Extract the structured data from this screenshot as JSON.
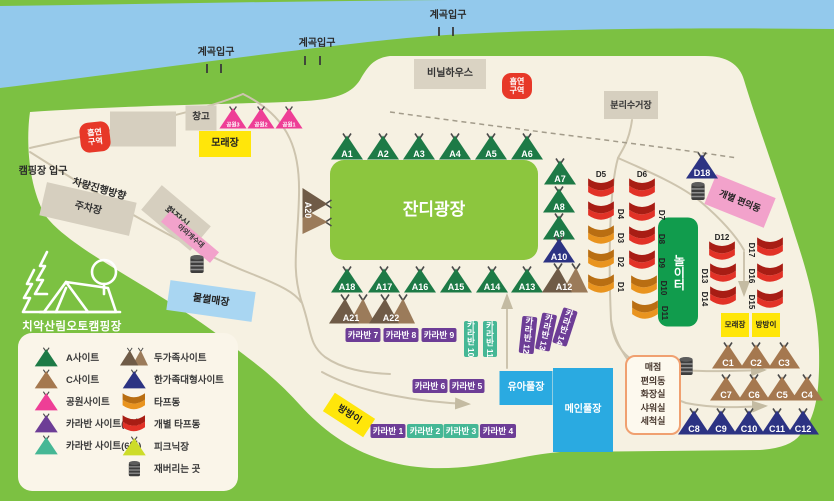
{
  "map": {
    "logo_text": "치악산림오토캠핑장",
    "colors": {
      "bg_green": "#7cc142",
      "river": "#93c9ec",
      "ground": "#f6f1e2",
      "building": "#d6cfbf",
      "yellow": "#ffe60a",
      "red_badge": "#e73828",
      "green_site": "#1d7a46",
      "navy_site": "#2c3383",
      "pink_site": "#ee3e96",
      "purple_site": "#6d3d96",
      "teal_site": "#45b795",
      "brown_site": "#a5784f",
      "brown_dark": "#6f5b47",
      "brown_light": "#9b7b5a",
      "red_tarp": "#e23227",
      "red_tarp_dark": "#a81d14",
      "orange_tarp": "#e9941f",
      "orange_tarp_dark": "#b96e12",
      "picnic": "#cddc29",
      "plaza": "#8cc63e",
      "play": "#119c4d",
      "pool": "#2aaae1",
      "sled": "#a9d6f2",
      "pink_box": "#f2a2cb"
    },
    "labels": [
      {
        "name": "valley-entrance-label-1",
        "text": "계곡입구",
        "x": 216,
        "y": 53,
        "size": 10
      },
      {
        "name": "valley-entrance-label-2",
        "text": "계곡입구",
        "x": 317,
        "y": 44,
        "size": 10
      },
      {
        "name": "valley-entrance-label-3",
        "text": "계곡입구",
        "x": 448,
        "y": 16,
        "size": 10
      },
      {
        "name": "campground-entrance-label",
        "text": "캠핑장 입구",
        "x": 43,
        "y": 172,
        "size": 10
      },
      {
        "name": "vehicle-direction-label",
        "text": "차량진행방향",
        "x": 99,
        "y": 190,
        "size": 10,
        "rotate": 16
      }
    ],
    "zones": [
      {
        "name": "zone-vinyl-house",
        "text": "비닐하우스",
        "x": 450,
        "y": 74,
        "w": 72,
        "h": 30,
        "bg": "#dad3c3",
        "fg": "#333",
        "size": 10
      },
      {
        "name": "zone-warehouse",
        "text": "창고",
        "x": 201,
        "y": 118,
        "w": 31,
        "h": 25,
        "bg": "#d6cfbf",
        "fg": "#333",
        "size": 9.5
      },
      {
        "name": "zone-building",
        "text": "",
        "x": 143,
        "y": 129,
        "w": 66,
        "h": 35,
        "bg": "#d6cfbf",
        "fg": "#333",
        "size": 9
      },
      {
        "name": "zone-recycling-station",
        "text": "분리수거장",
        "x": 631,
        "y": 105,
        "w": 54,
        "h": 28,
        "bg": "#d6cfbf",
        "fg": "#333",
        "size": 9
      },
      {
        "name": "zone-sand-area-top",
        "text": "모래장",
        "x": 225,
        "y": 144,
        "w": 52,
        "h": 26,
        "bg": "#ffe60a",
        "fg": "#222",
        "size": 10
      },
      {
        "name": "zone-parking-lot",
        "text": "주차장",
        "x": 88,
        "y": 209,
        "w": 92,
        "h": 34,
        "bg": "#d6cfbf",
        "fg": "#333",
        "size": 10,
        "rotate": 13
      },
      {
        "name": "zone-restroom",
        "text": "화장실",
        "x": 176,
        "y": 218,
        "w": 64,
        "h": 32,
        "bg": "#d6cfbf",
        "fg": "#333",
        "size": 10,
        "rotate": 40
      },
      {
        "name": "zone-outdoor-sink",
        "text": "야외개수대",
        "x": 190,
        "y": 237,
        "w": 64,
        "h": 14,
        "bg": "#f2a2cb",
        "fg": "#333",
        "size": 7,
        "rotate": 40
      },
      {
        "name": "zone-water-sled",
        "text": "물썰매장",
        "x": 211,
        "y": 301,
        "w": 86,
        "h": 30,
        "bg": "#a9d6f2",
        "fg": "#222",
        "size": 10,
        "rotate": 8
      },
      {
        "name": "zone-private-convenience",
        "text": "개별 편의동",
        "x": 740,
        "y": 201,
        "w": 64,
        "h": 32,
        "bg": "#f2a2cb",
        "fg": "#222",
        "size": 9,
        "rotate": 22
      },
      {
        "name": "zone-grass-plaza",
        "text": "잔디광장",
        "x": 434,
        "y": 210,
        "w": 208,
        "h": 100,
        "bg": "#8cc63e",
        "fg": "#fff",
        "size": 17,
        "radius": 14
      },
      {
        "name": "zone-playground",
        "text": "놀이터",
        "x": 678,
        "y": 272,
        "w": 40,
        "h": 109,
        "bg": "#119c4d",
        "fg": "#fff",
        "size": 12,
        "radius": 10,
        "vertical": true
      },
      {
        "name": "zone-kids-pool",
        "text": "유아풀장",
        "x": 526,
        "y": 388,
        "w": 53,
        "h": 34,
        "bg": "#2aaae1",
        "fg": "#fff",
        "size": 10
      },
      {
        "name": "zone-main-pool",
        "text": "메인풀장",
        "x": 583,
        "y": 410,
        "w": 60,
        "h": 84,
        "bg": "#2aaae1",
        "fg": "#fff",
        "size": 10
      },
      {
        "name": "zone-sand-area-right",
        "text": "모래장",
        "x": 735,
        "y": 325,
        "w": 28,
        "h": 24,
        "bg": "#ffe60a",
        "fg": "#222",
        "size": 7.5
      },
      {
        "name": "zone-bangbang-right",
        "text": "방방이",
        "x": 766,
        "y": 325,
        "w": 28,
        "h": 24,
        "bg": "#ffe60a",
        "fg": "#222",
        "size": 7.5
      },
      {
        "name": "zone-bangbang-bottom",
        "text": "방방이",
        "x": 349,
        "y": 415,
        "w": 48,
        "h": 22,
        "bg": "#ffe60a",
        "fg": "#222",
        "size": 9.5,
        "rotate": 33
      }
    ],
    "smoking_badges": [
      {
        "name": "smoking-area-badge-left",
        "lines": "흡연\n구역",
        "x": 95,
        "y": 137,
        "w": 30,
        "h": 30,
        "rotate": -6,
        "size": 8
      },
      {
        "name": "smoking-area-badge-right",
        "lines": "흡연\n구역",
        "x": 517,
        "y": 86,
        "w": 30,
        "h": 26,
        "rotate": 0,
        "size": 8
      }
    ],
    "caravans": [
      {
        "name": "caravan-7",
        "label": "카라반 7",
        "x": 363,
        "y": 335,
        "w": 35,
        "h": 14,
        "color": "purple"
      },
      {
        "name": "caravan-8",
        "label": "카라반 8",
        "x": 401,
        "y": 335,
        "w": 35,
        "h": 14,
        "color": "purple"
      },
      {
        "name": "caravan-9",
        "label": "카라반 9",
        "x": 439,
        "y": 335,
        "w": 35,
        "h": 14,
        "color": "purple"
      },
      {
        "name": "caravan-10",
        "label": "카라반 10",
        "x": 471,
        "y": 339,
        "w": 14,
        "h": 36,
        "color": "teal",
        "vertical": true
      },
      {
        "name": "caravan-11",
        "label": "카라반 11",
        "x": 490,
        "y": 339,
        "w": 14,
        "h": 36,
        "color": "teal",
        "vertical": true
      },
      {
        "name": "caravan-12",
        "label": "카라반 12",
        "x": 528,
        "y": 335,
        "w": 15,
        "h": 37,
        "color": "purple",
        "vertical": true,
        "rotate": 6
      },
      {
        "name": "caravan-13",
        "label": "카라반 13",
        "x": 546,
        "y": 332,
        "w": 15,
        "h": 37,
        "color": "purple",
        "vertical": true,
        "rotate": 12
      },
      {
        "name": "caravan-14",
        "label": "카라반 14",
        "x": 565,
        "y": 327,
        "w": 15,
        "h": 37,
        "color": "purple",
        "vertical": true,
        "rotate": 18
      },
      {
        "name": "caravan-6",
        "label": "카라반 6",
        "x": 430,
        "y": 386,
        "w": 35,
        "h": 14,
        "color": "purple"
      },
      {
        "name": "caravan-5",
        "label": "카라반 5",
        "x": 467,
        "y": 386,
        "w": 35,
        "h": 14,
        "color": "purple"
      },
      {
        "name": "caravan-1",
        "label": "카라반 1",
        "x": 388,
        "y": 431,
        "w": 35,
        "h": 14,
        "color": "purple"
      },
      {
        "name": "caravan-2",
        "label": "카라반 2",
        "x": 425,
        "y": 431,
        "w": 36,
        "h": 14,
        "color": "teal"
      },
      {
        "name": "caravan-3",
        "label": "카라반 3",
        "x": 461,
        "y": 431,
        "w": 35,
        "h": 14,
        "color": "teal"
      },
      {
        "name": "caravan-4",
        "label": "카라반 4",
        "x": 498,
        "y": 431,
        "w": 36,
        "h": 14,
        "color": "purple"
      }
    ],
    "tents": [
      {
        "name": "tent-A1",
        "id": "A1",
        "x": 347,
        "y": 149,
        "color": "green"
      },
      {
        "name": "tent-A2",
        "id": "A2",
        "x": 383,
        "y": 149,
        "color": "green"
      },
      {
        "name": "tent-A3",
        "id": "A3",
        "x": 419,
        "y": 149,
        "color": "green"
      },
      {
        "name": "tent-A4",
        "id": "A4",
        "x": 455,
        "y": 149,
        "color": "green"
      },
      {
        "name": "tent-A5",
        "id": "A5",
        "x": 491,
        "y": 149,
        "color": "green"
      },
      {
        "name": "tent-A6",
        "id": "A6",
        "x": 527,
        "y": 149,
        "color": "green"
      },
      {
        "name": "tent-A7",
        "id": "A7",
        "x": 560,
        "y": 174,
        "color": "green"
      },
      {
        "name": "tent-A8",
        "id": "A8",
        "x": 559,
        "y": 202,
        "color": "green"
      },
      {
        "name": "tent-A9",
        "id": "A9",
        "x": 559,
        "y": 229,
        "color": "green"
      },
      {
        "name": "tent-A10",
        "id": "A10",
        "x": 559,
        "y": 252,
        "color": "navy"
      },
      {
        "name": "tent-A18",
        "id": "A18",
        "x": 347,
        "y": 282,
        "color": "green"
      },
      {
        "name": "tent-A17",
        "id": "A17",
        "x": 384,
        "y": 282,
        "color": "green"
      },
      {
        "name": "tent-A16",
        "id": "A16",
        "x": 420,
        "y": 282,
        "color": "green"
      },
      {
        "name": "tent-A15",
        "id": "A15",
        "x": 456,
        "y": 282,
        "color": "green"
      },
      {
        "name": "tent-A14",
        "id": "A14",
        "x": 492,
        "y": 282,
        "color": "green"
      },
      {
        "name": "tent-A13",
        "id": "A13",
        "x": 527,
        "y": 282,
        "color": "green"
      },
      {
        "name": "tent-A12",
        "id": "A12",
        "x": 565,
        "y": 281,
        "type": "double"
      },
      {
        "name": "tent-A20",
        "id": "A20",
        "x": 314,
        "y": 211,
        "type": "double",
        "rotate": 90
      },
      {
        "name": "tent-A21",
        "id": "A21",
        "x": 352,
        "y": 312,
        "type": "double"
      },
      {
        "name": "tent-A22",
        "id": "A22",
        "x": 392,
        "y": 312,
        "type": "double"
      },
      {
        "name": "tent-park3",
        "id": "공원3",
        "x": 233,
        "y": 120,
        "color": "pink",
        "scale": 0.85,
        "font": 6.5
      },
      {
        "name": "tent-park2",
        "id": "공원2",
        "x": 261,
        "y": 120,
        "color": "pink",
        "scale": 0.85,
        "font": 6.5
      },
      {
        "name": "tent-park1",
        "id": "공원1",
        "x": 289,
        "y": 120,
        "color": "pink",
        "scale": 0.85,
        "font": 6.5
      },
      {
        "name": "tent-D18",
        "id": "D18",
        "x": 702,
        "y": 168,
        "color": "navy"
      },
      {
        "name": "tent-C1",
        "id": "C1",
        "x": 728,
        "y": 358,
        "color": "brown"
      },
      {
        "name": "tent-C2",
        "id": "C2",
        "x": 756,
        "y": 358,
        "color": "brown"
      },
      {
        "name": "tent-C3",
        "id": "C3",
        "x": 784,
        "y": 358,
        "color": "brown"
      },
      {
        "name": "tent-C7",
        "id": "C7",
        "x": 726,
        "y": 390,
        "color": "brown"
      },
      {
        "name": "tent-C6",
        "id": "C6",
        "x": 754,
        "y": 390,
        "color": "brown"
      },
      {
        "name": "tent-C5",
        "id": "C5",
        "x": 782,
        "y": 390,
        "color": "brown"
      },
      {
        "name": "tent-C4",
        "id": "C4",
        "x": 807,
        "y": 390,
        "color": "brown"
      },
      {
        "name": "tent-C8",
        "id": "C8",
        "x": 694,
        "y": 424,
        "color": "navy"
      },
      {
        "name": "tent-C9",
        "id": "C9",
        "x": 721,
        "y": 424,
        "color": "navy"
      },
      {
        "name": "tent-C10",
        "id": "C10",
        "x": 749,
        "y": 424,
        "color": "navy"
      },
      {
        "name": "tent-C11",
        "id": "C11",
        "x": 777,
        "y": 424,
        "color": "navy"
      },
      {
        "name": "tent-C12",
        "id": "C12",
        "x": 803,
        "y": 424,
        "color": "navy"
      }
    ],
    "tarps": [
      {
        "name": "tarp-D5",
        "id": "D5",
        "x": 601,
        "y": 191,
        "color": "red",
        "label_pos": "top"
      },
      {
        "name": "tarp-D4",
        "id": "D4",
        "x": 601,
        "y": 214,
        "color": "red",
        "label_pos": "right"
      },
      {
        "name": "tarp-D3",
        "id": "D3",
        "x": 601,
        "y": 238,
        "color": "orange",
        "label_pos": "right"
      },
      {
        "name": "tarp-D2",
        "id": "D2",
        "x": 601,
        "y": 262,
        "color": "orange",
        "label_pos": "right"
      },
      {
        "name": "tarp-D1",
        "id": "D1",
        "x": 601,
        "y": 287,
        "color": "orange",
        "label_pos": "right"
      },
      {
        "name": "tarp-D6",
        "id": "D6",
        "x": 642,
        "y": 191,
        "color": "red",
        "label_pos": "top"
      },
      {
        "name": "tarp-D7",
        "id": "D7",
        "x": 642,
        "y": 215,
        "color": "red",
        "label_pos": "right"
      },
      {
        "name": "tarp-D8",
        "id": "D8",
        "x": 642,
        "y": 239,
        "color": "red",
        "label_pos": "right"
      },
      {
        "name": "tarp-D9",
        "id": "D9",
        "x": 642,
        "y": 263,
        "color": "red",
        "label_pos": "right"
      },
      {
        "name": "tarp-D10",
        "id": "D10",
        "x": 644,
        "y": 288,
        "color": "orange",
        "label_pos": "right"
      },
      {
        "name": "tarp-D11",
        "id": "D11",
        "x": 645,
        "y": 313,
        "color": "orange",
        "label_pos": "right"
      },
      {
        "name": "tarp-D12",
        "id": "D12",
        "x": 722,
        "y": 254,
        "color": "red",
        "label_pos": "top"
      },
      {
        "name": "tarp-D13",
        "id": "D13",
        "x": 723,
        "y": 276,
        "color": "red",
        "label_pos": "left"
      },
      {
        "name": "tarp-D14",
        "id": "D14",
        "x": 723,
        "y": 299,
        "color": "red",
        "label_pos": "left"
      },
      {
        "name": "tarp-D17",
        "id": "D17",
        "x": 770,
        "y": 250,
        "color": "red",
        "label_pos": "left"
      },
      {
        "name": "tarp-D16",
        "id": "D16",
        "x": 770,
        "y": 276,
        "color": "red",
        "label_pos": "left"
      },
      {
        "name": "tarp-D15",
        "id": "D15",
        "x": 770,
        "y": 302,
        "color": "red",
        "label_pos": "left"
      }
    ],
    "barrels": [
      {
        "name": "trash-barrel-1",
        "x": 197,
        "y": 267
      },
      {
        "name": "trash-barrel-2",
        "x": 698,
        "y": 194
      },
      {
        "name": "trash-barrel-3",
        "x": 686,
        "y": 369
      }
    ],
    "store": {
      "name": "store-block",
      "lines": [
        "매점",
        "편의동",
        "화장실",
        "샤워실",
        "세척실"
      ],
      "x": 651,
      "y": 393,
      "w": 52,
      "h": 76
    },
    "legend": {
      "left": [
        {
          "label": "A사이트",
          "icon": "tent",
          "color": "green"
        },
        {
          "label": "C사이트",
          "icon": "tent",
          "color": "brown"
        },
        {
          "label": "공원사이트",
          "icon": "tent",
          "color": "pink"
        },
        {
          "label": "카라반 사이트(4인)",
          "icon": "tent",
          "color": "purple"
        },
        {
          "label": "카라반 사이트(6인)",
          "icon": "tent",
          "color": "teal"
        }
      ],
      "right": [
        {
          "label": "두가족사이트",
          "icon": "double"
        },
        {
          "label": "한가족대형사이트",
          "icon": "tent",
          "color": "navy"
        },
        {
          "label": "타프동",
          "icon": "tarp",
          "color": "orange"
        },
        {
          "label": "개별 타프동",
          "icon": "tarp",
          "color": "red"
        },
        {
          "label": "피크닉장",
          "icon": "tent",
          "color": "picnic"
        },
        {
          "label": "재버리는 곳",
          "icon": "barrel"
        }
      ]
    }
  }
}
